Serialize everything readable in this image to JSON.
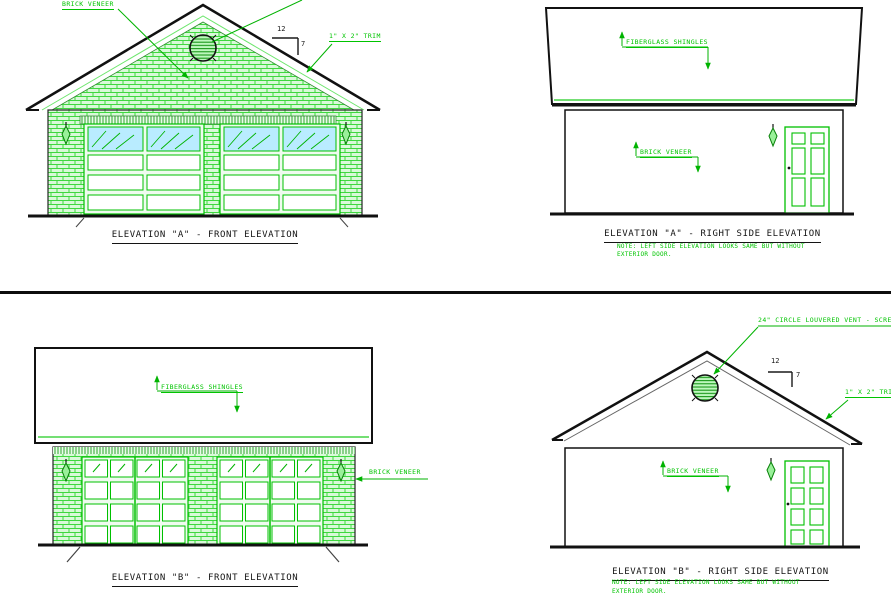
{
  "colors": {
    "annotation_green": "#00c400",
    "brick_hatch_green": "#3fd83f",
    "glass_cyan": "#b9ecff",
    "line_black": "#111111"
  },
  "elevations": {
    "a_front": {
      "title": "ELEVATION \"A\" - FRONT ELEVATION",
      "brick_veneer_label": "BRICK VENEER",
      "trim_label": "1\" X 2\" TRIM",
      "pitch_run": "12",
      "pitch_rise": "7"
    },
    "a_side": {
      "title": "ELEVATION \"A\" - RIGHT SIDE ELEVATION",
      "shingles_label": "FIBERGLASS SHINGLES",
      "brick_veneer_label": "BRICK VENEER",
      "note_line1": "NOTE: LEFT SIDE ELEVATION LOOKS SAME BUT WITHOUT",
      "note_line2": "EXTERIOR DOOR."
    },
    "b_front": {
      "title": "ELEVATION \"B\" - FRONT ELEVATION",
      "shingles_label": "FIBERGLASS SHINGLES",
      "brick_veneer_label": "BRICK VENEER"
    },
    "b_side": {
      "title": "ELEVATION \"B\" - RIGHT SIDE ELEVATION",
      "vent_label": "24\" CIRCLE LOUVERED VENT - SCREEN",
      "trim_label": "1\" X 2\" TRIM",
      "brick_veneer_label": "BRICK VENEER",
      "pitch_run": "12",
      "pitch_rise": "7",
      "note_line1": "NOTE: LEFT SIDE ELEVATION LOOKS SAME BUT WITHOUT",
      "note_line2": "EXTERIOR DOOR."
    }
  }
}
